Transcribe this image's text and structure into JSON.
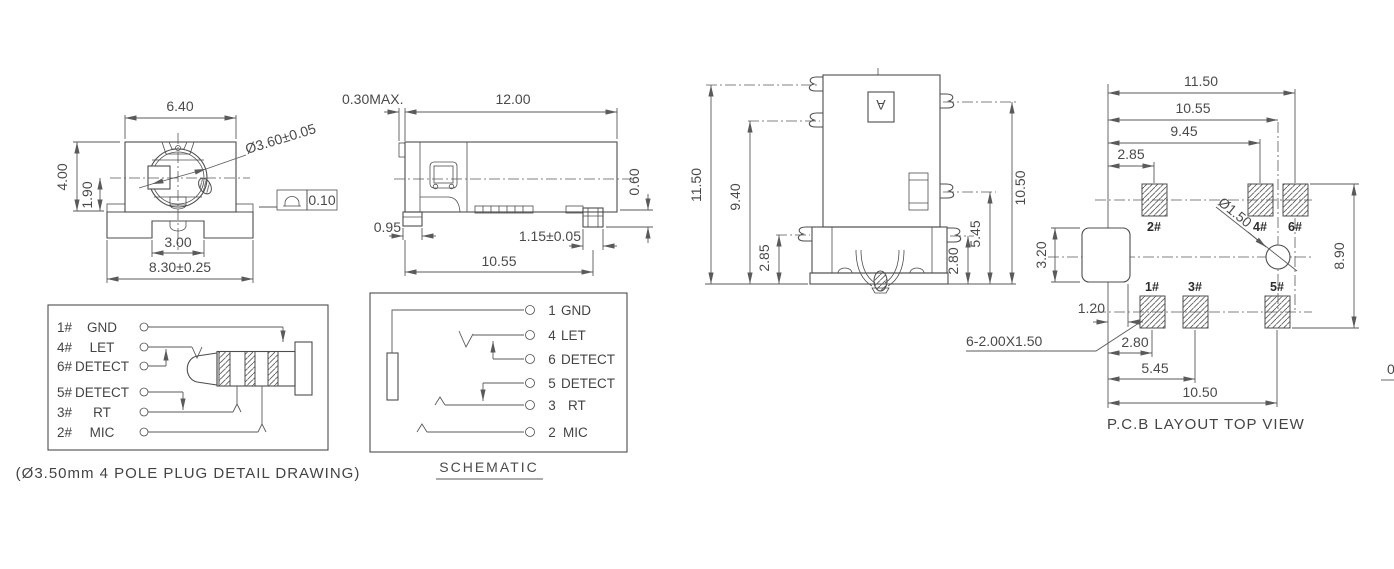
{
  "front_view": {
    "dim_top_width": "6.40",
    "dim_height": "4.00",
    "dim_center_height": "1.90",
    "dim_hole_diameter": "Ø3.60±0.05",
    "dim_notch_width": "3.00",
    "dim_base_width": "8.30±0.25",
    "tolerance_value": "0.10"
  },
  "side_view": {
    "dim_protrusion": "0.30MAX.",
    "dim_length": "12.00",
    "dim_standoff": "0.60",
    "dim_foot_width": "0.95",
    "dim_pad_width": "1.15±0.05",
    "dim_span": "10.55"
  },
  "back_view": {
    "dim_total_height": "11.50",
    "dim_lead_mid": "9.40",
    "dim_lead_low": "2.85",
    "dim_right_low": "2.80",
    "dim_right_mid": "5.45",
    "dim_right_top": "10.50",
    "marking": "A"
  },
  "pcb_view": {
    "dim_width_total": "11.50",
    "dim_width_2": "10.55",
    "dim_width_3": "9.45",
    "dim_width_4": "2.85",
    "dim_hole": "Ø1.50",
    "dim_notch_height": "3.20",
    "dim_left_offset": "1.20",
    "pad_note": "6-2.00X1.50",
    "dim_bottom_1": "2.80",
    "dim_bottom_2": "5.45",
    "dim_bottom_3": "10.50",
    "dim_pad_span": "8.90",
    "pad_labels_top": [
      "2#",
      "4#",
      "6#"
    ],
    "pad_labels_bottom": [
      "1#",
      "3#",
      "5#"
    ],
    "caption": "P.C.B LAYOUT TOP VIEW"
  },
  "plug_detail": {
    "pins": [
      {
        "num": "1#",
        "name": "GND"
      },
      {
        "num": "4#",
        "name": "LET"
      },
      {
        "num": "6#",
        "name": "DETECT"
      },
      {
        "num": "5#",
        "name": "DETECT"
      },
      {
        "num": "3#",
        "name": "RT"
      },
      {
        "num": "2#",
        "name": "MIC"
      }
    ],
    "caption": "(Ø3.50mm 4 POLE PLUG DETAIL DRAWING)"
  },
  "schematic": {
    "pins": [
      {
        "num": "1",
        "name": "GND"
      },
      {
        "num": "4",
        "name": "LET"
      },
      {
        "num": "6",
        "name": "DETECT"
      },
      {
        "num": "5",
        "name": "DETECT"
      },
      {
        "num": "3",
        "name": "RT"
      },
      {
        "num": "2",
        "name": "MIC"
      }
    ],
    "caption": "SCHEMATIC"
  },
  "edge_fragment": "0",
  "colors": {
    "line": "#4d4d4d",
    "dimension": "#5a5a5a",
    "text": "#4a4a4a",
    "background": "#ffffff"
  }
}
